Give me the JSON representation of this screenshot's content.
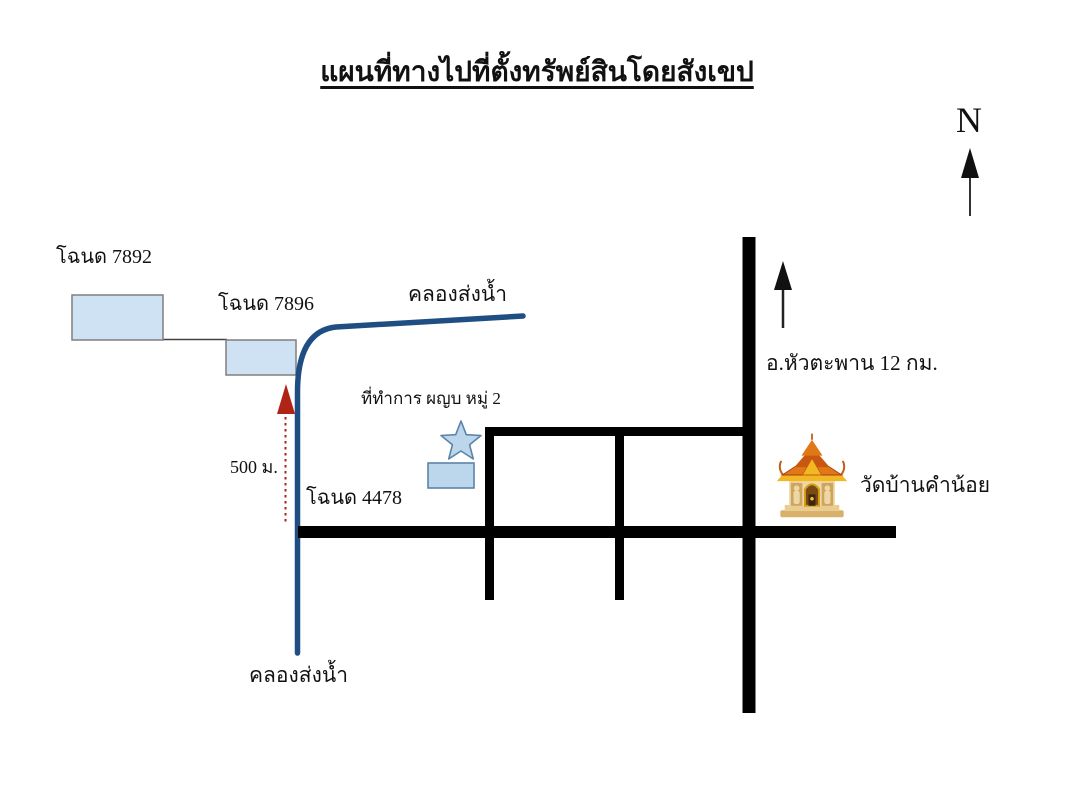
{
  "map": {
    "title": "แผนที่ทางไปที่ตั้งทรัพย์สินโดยสังเขป",
    "compass_label": "N",
    "labels": {
      "deed_7892": "โฉนด 7892",
      "deed_7896": "โฉนด 7896",
      "deed_4478": "โฉนด 4478",
      "canal_upper": "คลองส่งน้ำ",
      "canal_lower": "คลองส่งน้ำ",
      "headman_office": "ที่ทำการ ผญบ หมู่ 2",
      "distance_500m": "500 ม.",
      "district_distance": "อ.หัวตะพาน 12 กม.",
      "temple_name": "วัดบ้านคำน้อย"
    },
    "icons": [
      "north-arrow-icon",
      "direction-arrow-icon",
      "distance-arrow-icon",
      "star-marker-icon",
      "temple-icon"
    ],
    "colors": {
      "road": "#000000",
      "canal": "#1f4e82",
      "parcel_fill": "#cfe2f3",
      "parcel_stroke": "#7f7f7f",
      "marker_fill": "#bcd6ec",
      "marker_stroke": "#5b84a8",
      "distance_arrow": "#b02418",
      "text": "#111111"
    }
  }
}
